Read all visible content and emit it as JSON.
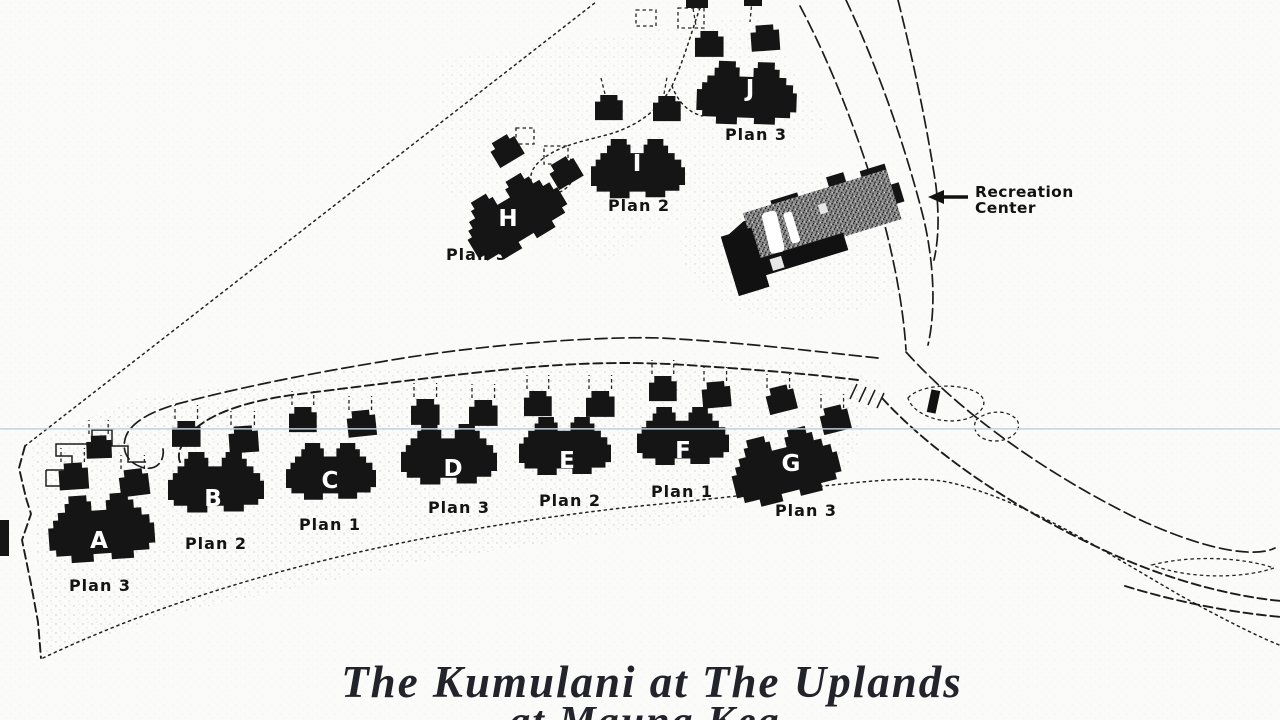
{
  "map": {
    "title_line1": "The Kumulani at The Uplands",
    "title_line2": "at Mauna Kea",
    "recreation_center": {
      "line1": "Recreation",
      "line2": "Center"
    },
    "colors": {
      "ink": "#1c1c1c",
      "building_fill": "#151515",
      "paper": "#fbfbfa",
      "rec_center_gray": "#8f8f8f",
      "scan_artifact_line": "#b9d2e0"
    },
    "buildings": [
      {
        "letter": "A",
        "plan": "Plan 3",
        "body": [
          46,
          498,
          0.53,
          -4
        ],
        "letter_pos": [
          99,
          548
        ],
        "plan_pos": [
          100,
          591
        ],
        "garages": [
          [
            58,
            464,
            0.7,
            -4
          ],
          [
            86,
            436,
            0.6,
            -2
          ],
          [
            118,
            471,
            0.7,
            -7
          ]
        ],
        "stubs": true
      },
      {
        "letter": "B",
        "plan": "Plan 2",
        "body": [
          168,
          452,
          0.48,
          0
        ],
        "letter_pos": [
          213,
          506
        ],
        "plan_pos": [
          216,
          549
        ],
        "garages": [
          [
            172,
            421,
            0.68,
            0
          ],
          [
            228,
            427,
            0.7,
            -4
          ]
        ],
        "stubs": true
      },
      {
        "letter": "C",
        "plan": "Plan 1",
        "body": [
          286,
          443,
          0.45,
          0
        ],
        "letter_pos": [
          330,
          488
        ],
        "plan_pos": [
          330,
          530
        ],
        "garages": [
          [
            289,
            407,
            0.66,
            0
          ],
          [
            346,
            412,
            0.68,
            -6
          ]
        ],
        "stubs": true
      },
      {
        "letter": "D",
        "plan": "Plan 3",
        "body": [
          401,
          424,
          0.48,
          0
        ],
        "letter_pos": [
          453,
          476
        ],
        "plan_pos": [
          459,
          513
        ],
        "garages": [
          [
            411,
            399,
            0.68,
            0
          ],
          [
            469,
            400,
            0.68,
            0
          ]
        ],
        "stubs": true
      },
      {
        "letter": "E",
        "plan": "Plan 2",
        "body": [
          519,
          417,
          0.46,
          0
        ],
        "letter_pos": [
          567,
          468
        ],
        "plan_pos": [
          570,
          506
        ],
        "garages": [
          [
            524,
            391,
            0.66,
            0
          ],
          [
            586,
            391,
            0.68,
            0
          ]
        ],
        "stubs": true
      },
      {
        "letter": "F",
        "plan": "Plan 1",
        "body": [
          637,
          407,
          0.46,
          0
        ],
        "letter_pos": [
          683,
          458
        ],
        "plan_pos": [
          682,
          497
        ],
        "garages": [
          [
            649,
            376,
            0.66,
            0
          ],
          [
            701,
            383,
            0.68,
            -5
          ]
        ],
        "stubs": true
      },
      {
        "letter": "G",
        "plan": "Plan 3",
        "body": [
          724,
          446,
          0.54,
          -14
        ],
        "letter_pos": [
          791,
          471
        ],
        "plan_pos": [
          806,
          516
        ],
        "garages": [
          [
            764,
            390,
            0.68,
            -14
          ],
          [
            818,
            410,
            0.68,
            -14
          ]
        ],
        "stubs": true
      },
      {
        "letter": "H",
        "plan": "Plan 3",
        "body": [
          452,
          214,
          0.52,
          -31
        ],
        "letter_pos": [
          508,
          226
        ],
        "plan_pos": [
          477,
          260
        ],
        "garages": [
          [
            487,
            146,
            0.68,
            -31
          ],
          [
            546,
            168,
            0.68,
            -31
          ]
        ],
        "stubs": false
      },
      {
        "letter": "I",
        "plan": "Plan 2",
        "body": [
          591,
          139,
          0.47,
          0
        ],
        "letter_pos": [
          637,
          171
        ],
        "plan_pos": [
          639,
          211
        ],
        "garages": [
          [
            595,
            95,
            0.66,
            0
          ],
          [
            653,
            96,
            0.66,
            0
          ]
        ],
        "stubs": false
      },
      {
        "letter": "J",
        "plan": "Plan 3",
        "body": [
          698,
          60,
          0.5,
          2
        ],
        "letter_pos": [
          750,
          96
        ],
        "plan_pos": [
          756,
          140
        ],
        "garages": [
          [
            695,
            31,
            0.68,
            0
          ],
          [
            750,
            26,
            0.68,
            -4
          ]
        ],
        "stubs": false
      }
    ]
  }
}
